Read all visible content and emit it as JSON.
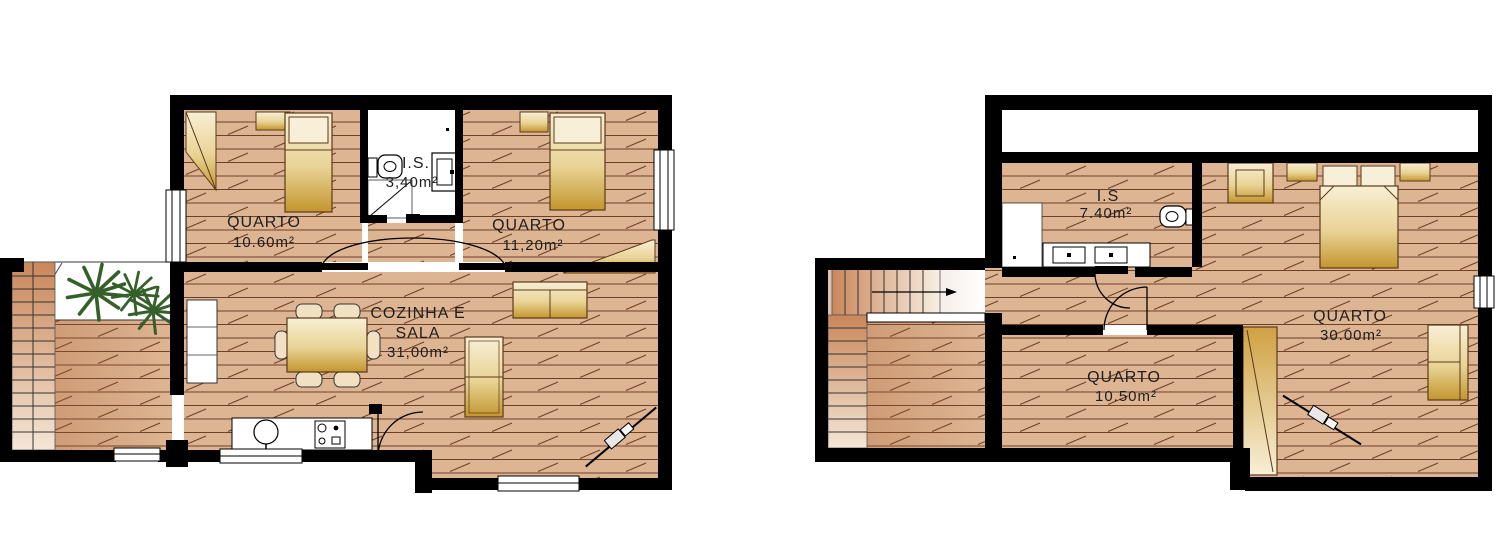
{
  "drawing": {
    "palette": {
      "wall": "#000000",
      "floor_base": "#deb593",
      "floor_line": "#6f4028",
      "furniture_gold_light": "#f8efd5",
      "furniture_gold_dark": "#c3962e",
      "plant_green": "#356029",
      "label": "#1e1e1e",
      "paper": "#ffffff"
    },
    "floors": [
      {
        "id": "ground-floor",
        "rooms": [
          {
            "name": "QUARTO",
            "area": "10.60m²"
          },
          {
            "name": "I.S.",
            "area": "3,40m²"
          },
          {
            "name": "QUARTO",
            "area": "11,20m²"
          },
          {
            "name_line1": "COZINHA E",
            "name_line2": "SALA",
            "area": "31,00m²"
          }
        ]
      },
      {
        "id": "upper-floor",
        "rooms": [
          {
            "name": "I.S",
            "area": "7.40m²"
          },
          {
            "name": "QUARTO",
            "area": "30.00m²"
          },
          {
            "name": "QUARTO",
            "area": "10.50m²"
          }
        ]
      }
    ]
  }
}
